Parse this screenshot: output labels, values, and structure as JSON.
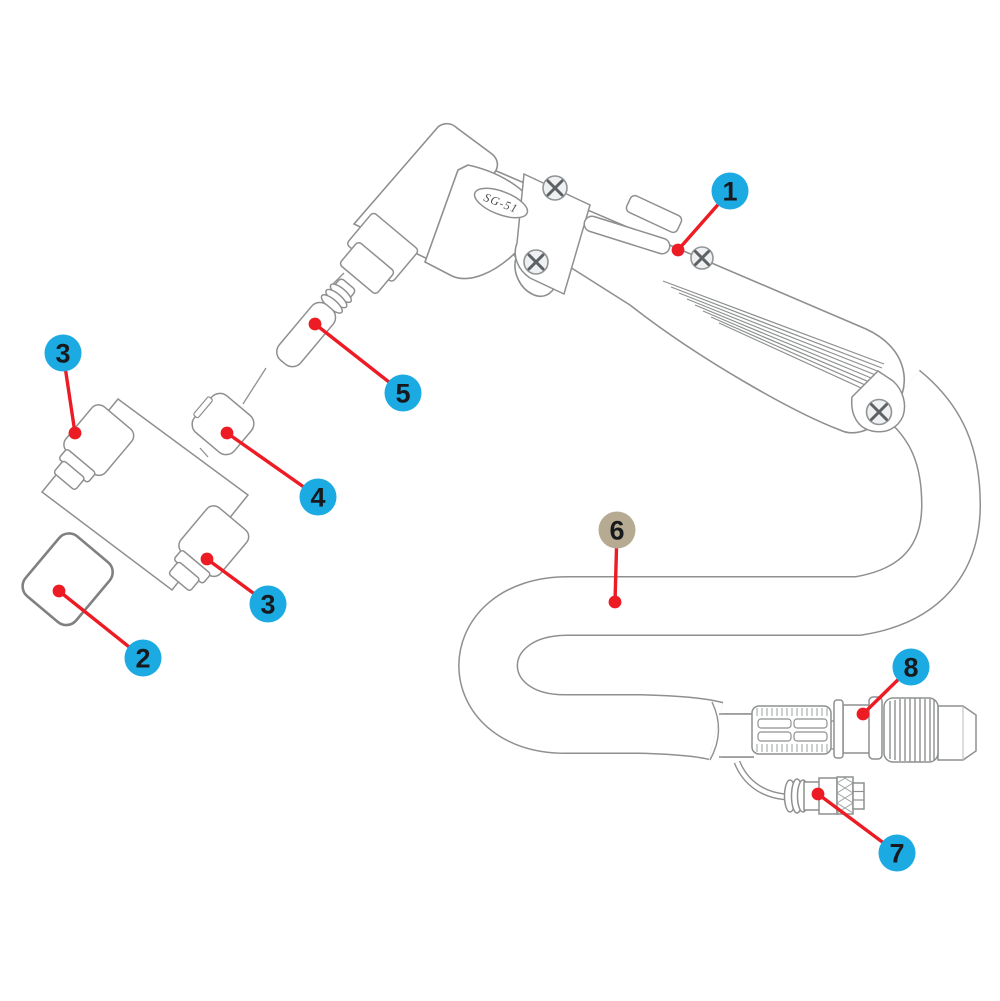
{
  "diagram": {
    "title": "Torch exploded parts diagram",
    "product_label": "SG-51",
    "colors": {
      "callout_blue": "#1caae2",
      "callout_tan": "#b7aa92",
      "leader_red": "#ed1c24",
      "line_gray": "#8e9090",
      "dark_outline": "#7e8082",
      "number_dark": "#17191c"
    },
    "callouts": [
      {
        "number": "1",
        "x": 730,
        "y": 191,
        "dot_x": 678,
        "dot_y": 250,
        "style": "blue"
      },
      {
        "number": "3",
        "x": 63,
        "y": 353,
        "dot_x": 75,
        "dot_y": 433,
        "style": "blue"
      },
      {
        "number": "5",
        "x": 403,
        "y": 393,
        "dot_x": 315,
        "dot_y": 324,
        "style": "blue"
      },
      {
        "number": "4",
        "x": 318,
        "y": 497,
        "dot_x": 227,
        "dot_y": 433,
        "style": "blue"
      },
      {
        "number": "3",
        "x": 268,
        "y": 604,
        "dot_x": 207,
        "dot_y": 559,
        "style": "blue"
      },
      {
        "number": "2",
        "x": 143,
        "y": 658,
        "dot_x": 59,
        "dot_y": 591,
        "style": "blue"
      },
      {
        "number": "6",
        "x": 617,
        "y": 530,
        "dot_x": 615,
        "dot_y": 602,
        "style": "tan"
      },
      {
        "number": "8",
        "x": 911,
        "y": 667,
        "dot_x": 863,
        "dot_y": 714,
        "style": "blue"
      },
      {
        "number": "7",
        "x": 897,
        "y": 853,
        "dot_x": 818,
        "dot_y": 794,
        "style": "blue"
      }
    ]
  }
}
